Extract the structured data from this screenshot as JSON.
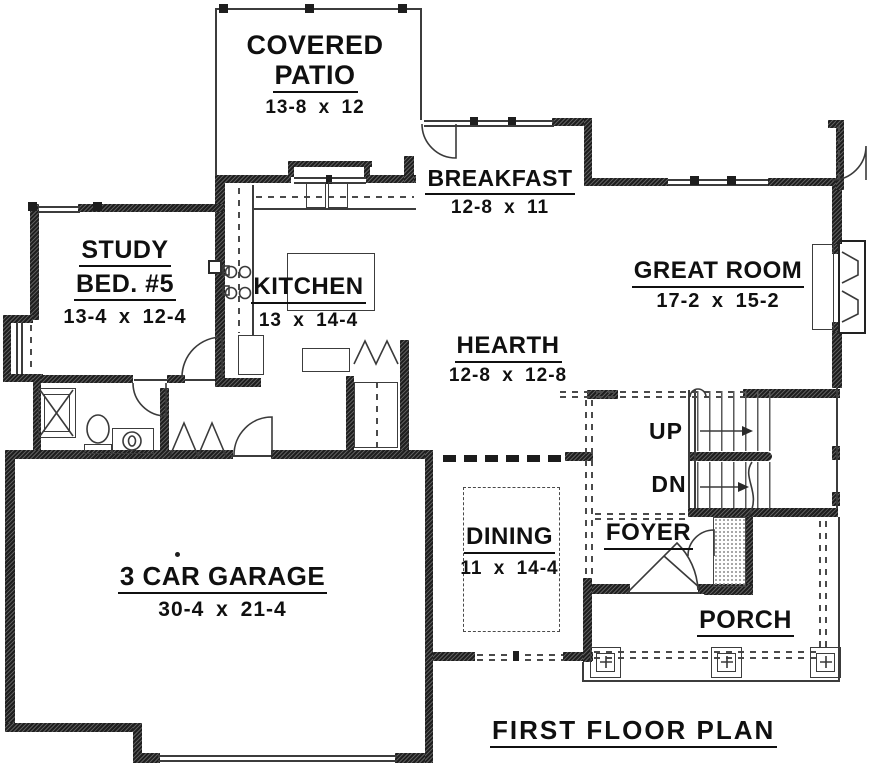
{
  "plan": {
    "title": "FIRST FLOOR PLAN",
    "rooms": {
      "patio": {
        "l1": "COVERED",
        "l2": "PATIO",
        "dims": "13-8 x 12"
      },
      "breakfast": {
        "label": "BREAKFAST",
        "dims": "12-8 x 11"
      },
      "study": {
        "l1": "STUDY",
        "l2": "BED. #5",
        "dims": "13-4 x 12-4"
      },
      "kitchen": {
        "label": "KITCHEN",
        "dims": "13 x 14-4"
      },
      "great_room": {
        "label": "GREAT ROOM",
        "dims": "17-2 x 15-2"
      },
      "hearth": {
        "label": "HEARTH",
        "dims": "12-8 x 12-8"
      },
      "dining": {
        "label": "DINING",
        "dims": "11 x 14-4"
      },
      "foyer": {
        "label": "FOYER"
      },
      "garage": {
        "label": "3 CAR GARAGE",
        "dims": "30-4 x 21-4"
      },
      "porch": {
        "label": "PORCH"
      }
    },
    "stairs": {
      "up": "UP",
      "down": "DN"
    }
  },
  "colors": {
    "wall": "#1e1e1e",
    "line": "#3c3c3c",
    "text": "#101010",
    "background": "#ffffff"
  }
}
